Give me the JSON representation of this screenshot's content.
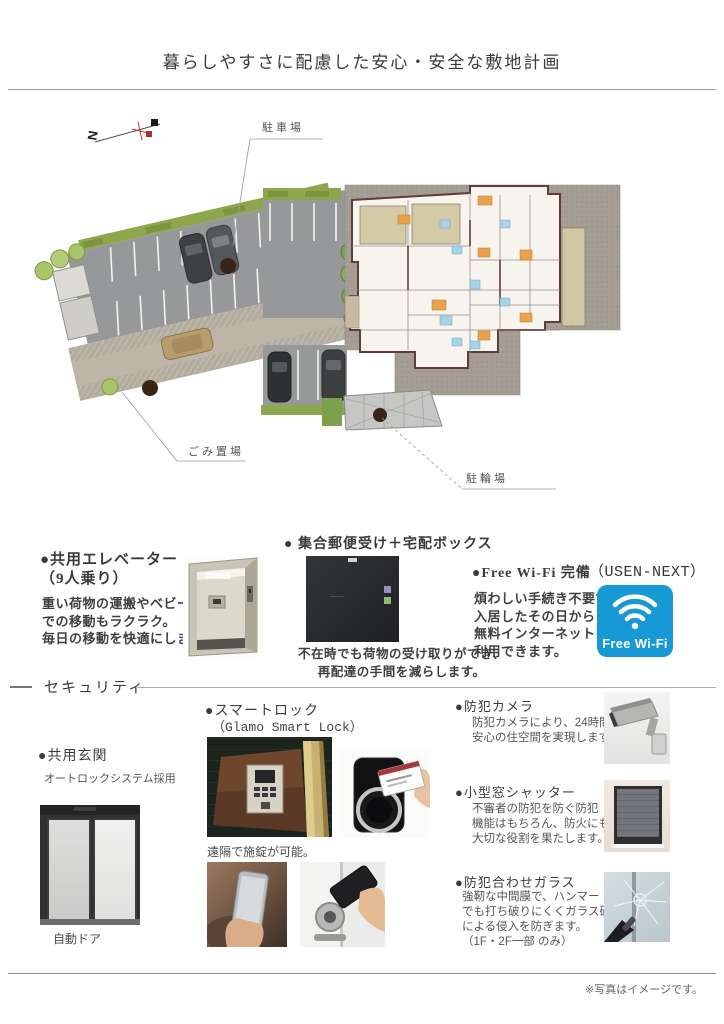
{
  "page": {
    "title": "暮らしやすさに配慮した安心・安全な敷地計画",
    "footer_note": "※写真はイメージです。"
  },
  "site_plan": {
    "compass": "N",
    "parking_label": "駐車場",
    "garbage_label": "ごみ置場",
    "bicycle_label": "駐輪場"
  },
  "features": {
    "elevator": {
      "title": "●共用エレベーター",
      "subtitle": "（9人乗り）",
      "line1": "重い荷物の運搬やベビーカー",
      "line2": "での移動もラクラク。",
      "line3": "毎日の移動を快適にします。"
    },
    "mailbox": {
      "title": "● 集合郵便受け＋宅配ボックス",
      "line1": "不在時でも荷物の受け取りができ、",
      "line2": "再配達の手間を減らします。"
    },
    "wifi": {
      "title": "●Free Wi-Fi 完備",
      "provider": "（USEN-NEXT）",
      "line1": "煩わしい手続き不要で",
      "line2": "入居したその日から",
      "line3": "無料インターネットを",
      "line4": "利用できます。",
      "logo_text": "Free Wi-Fi",
      "logo_color": "#1799d5"
    }
  },
  "security": {
    "heading": "セキュリティ",
    "entrance": {
      "title": "●共用玄関",
      "subtitle": "オートロックシステム採用",
      "caption": "自動ドア"
    },
    "smartlock": {
      "title": "●スマートロック",
      "subtitle": "（Glamo Smart Lock）",
      "caption": "遠隔で施錠が可能。"
    },
    "camera": {
      "title": "●防犯カメラ",
      "line1": "防犯カメラにより、24時間",
      "line2": "安心の住空間を実現します。"
    },
    "shutter": {
      "title": "●小型窓シャッター",
      "line1": "不審者の防犯を防ぐ防犯",
      "line2": "機能はもちろん、防火にも",
      "line3": "大切な役割を果たします。"
    },
    "glass": {
      "title": "●防犯合わせガラス",
      "line1": "強靭な中間膜で、ハンマー",
      "line2": "でも打ち破りにくくガラス破り",
      "line3": "による侵入を防ぎます。",
      "line4": "（1F・2F一部 のみ）"
    }
  }
}
